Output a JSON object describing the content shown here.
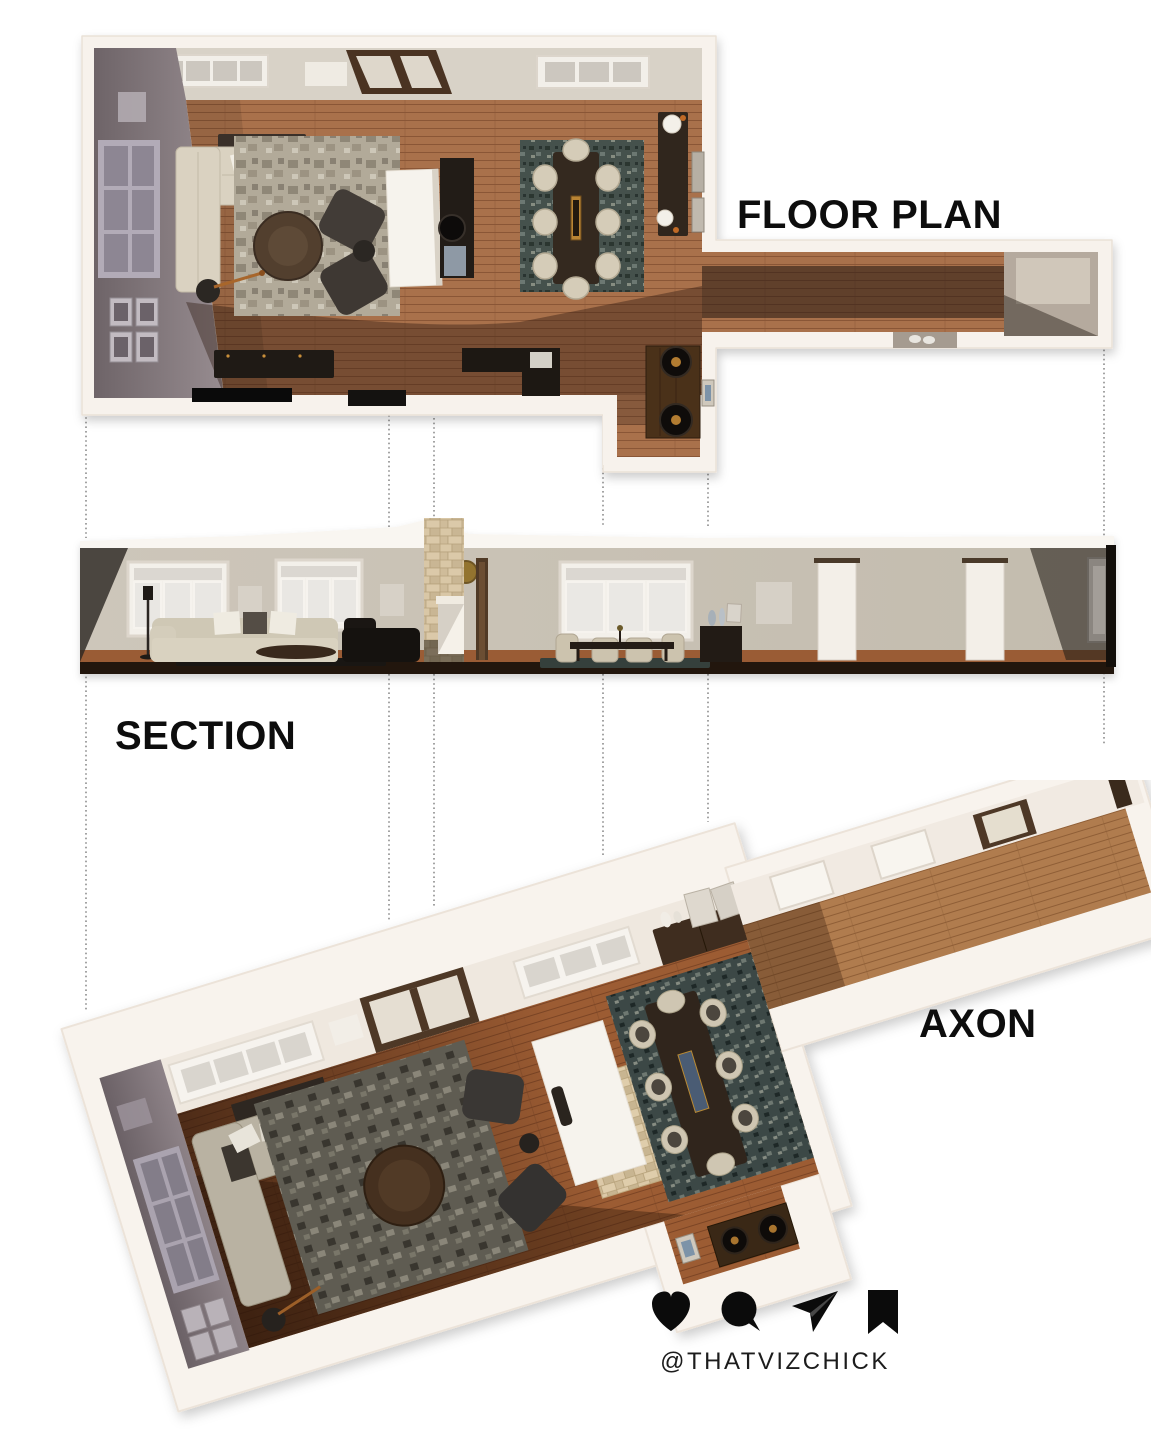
{
  "page": {
    "title": "Interior design presentation board"
  },
  "views": {
    "floor_plan": {
      "label": "FLOOR PLAN"
    },
    "section": {
      "label": "SECTION"
    },
    "axon": {
      "label": "AXON"
    }
  },
  "footer": {
    "handle": "@THATVIZCHICK",
    "icons": [
      {
        "name": "heart-icon"
      },
      {
        "name": "comment-icon"
      },
      {
        "name": "share-icon"
      },
      {
        "name": "bookmark-icon"
      }
    ]
  },
  "colors": {
    "wood_floor": "#a9714b",
    "axon_wood_floor": "#8a5130",
    "wall_cream": "#f7f2ec",
    "wall_greige": "#cdc6ba",
    "wall_gray_shadow": "#857a80",
    "furniture_dark": "#342b24",
    "sofa_cream": "#d9d2c1",
    "stone_travertine": "#d2bf9e",
    "dining_rug": "#45514c",
    "ink": "#111111"
  }
}
